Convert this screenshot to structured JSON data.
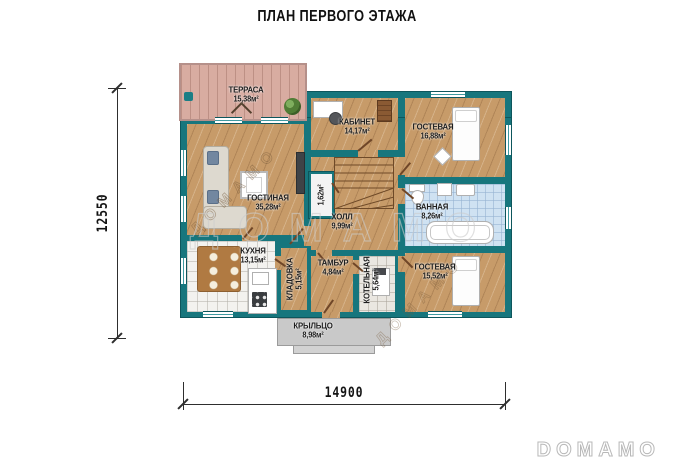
{
  "title": "ПЛАН ПЕРВОГО ЭТАЖА",
  "watermark": {
    "main": "ДОМАМО",
    "diag1": "ДОМАМО",
    "diag2": "ДОМАМО",
    "logo": "DOMAMO"
  },
  "dimensions": {
    "vertical": "12550",
    "horizontal": "14900"
  },
  "palette": {
    "wall": "#17767d",
    "wood_floor": "#c79b69",
    "terrace_deck": "#d8aca1",
    "bath_tile": "#cfe2f2",
    "kitchen_tile": "#f3f2ef",
    "boiler_tile": "#eae7e1",
    "porch": "#c9c9c9",
    "label_text": "#1e1e1e",
    "dimension_text": "#141414",
    "watermark_gray": "#cccccc"
  },
  "rooms": {
    "terrace": {
      "name": "ТЕРРАСА",
      "area": "15,38м²"
    },
    "study": {
      "name": "КАБИНЕТ",
      "area": "14,17м²"
    },
    "guest1": {
      "name": "ГОСТЕВАЯ",
      "area": "16,88м²"
    },
    "living": {
      "name": "ГОСТИНАЯ",
      "area": "35,28м²"
    },
    "hall": {
      "name": "ХОЛЛ",
      "area": "9,99м²"
    },
    "closet": {
      "name": "",
      "area": "1,62м²"
    },
    "bath": {
      "name": "ВАННАЯ",
      "area": "8,26м²"
    },
    "kitchen": {
      "name": "КУХНЯ",
      "area": "13,15м²"
    },
    "storage": {
      "name": "КЛАДОВКА",
      "area": "5,15м²"
    },
    "vestibule": {
      "name": "ТАМБУР",
      "area": "4,84м²"
    },
    "boiler": {
      "name": "КОТЕЛЬНАЯ",
      "area": "5,64м²"
    },
    "guest2": {
      "name": "ГОСТЕВАЯ",
      "area": "15,52м²"
    },
    "porch": {
      "name": "КРЫЛЬЦО",
      "area": "8,98м²"
    }
  }
}
